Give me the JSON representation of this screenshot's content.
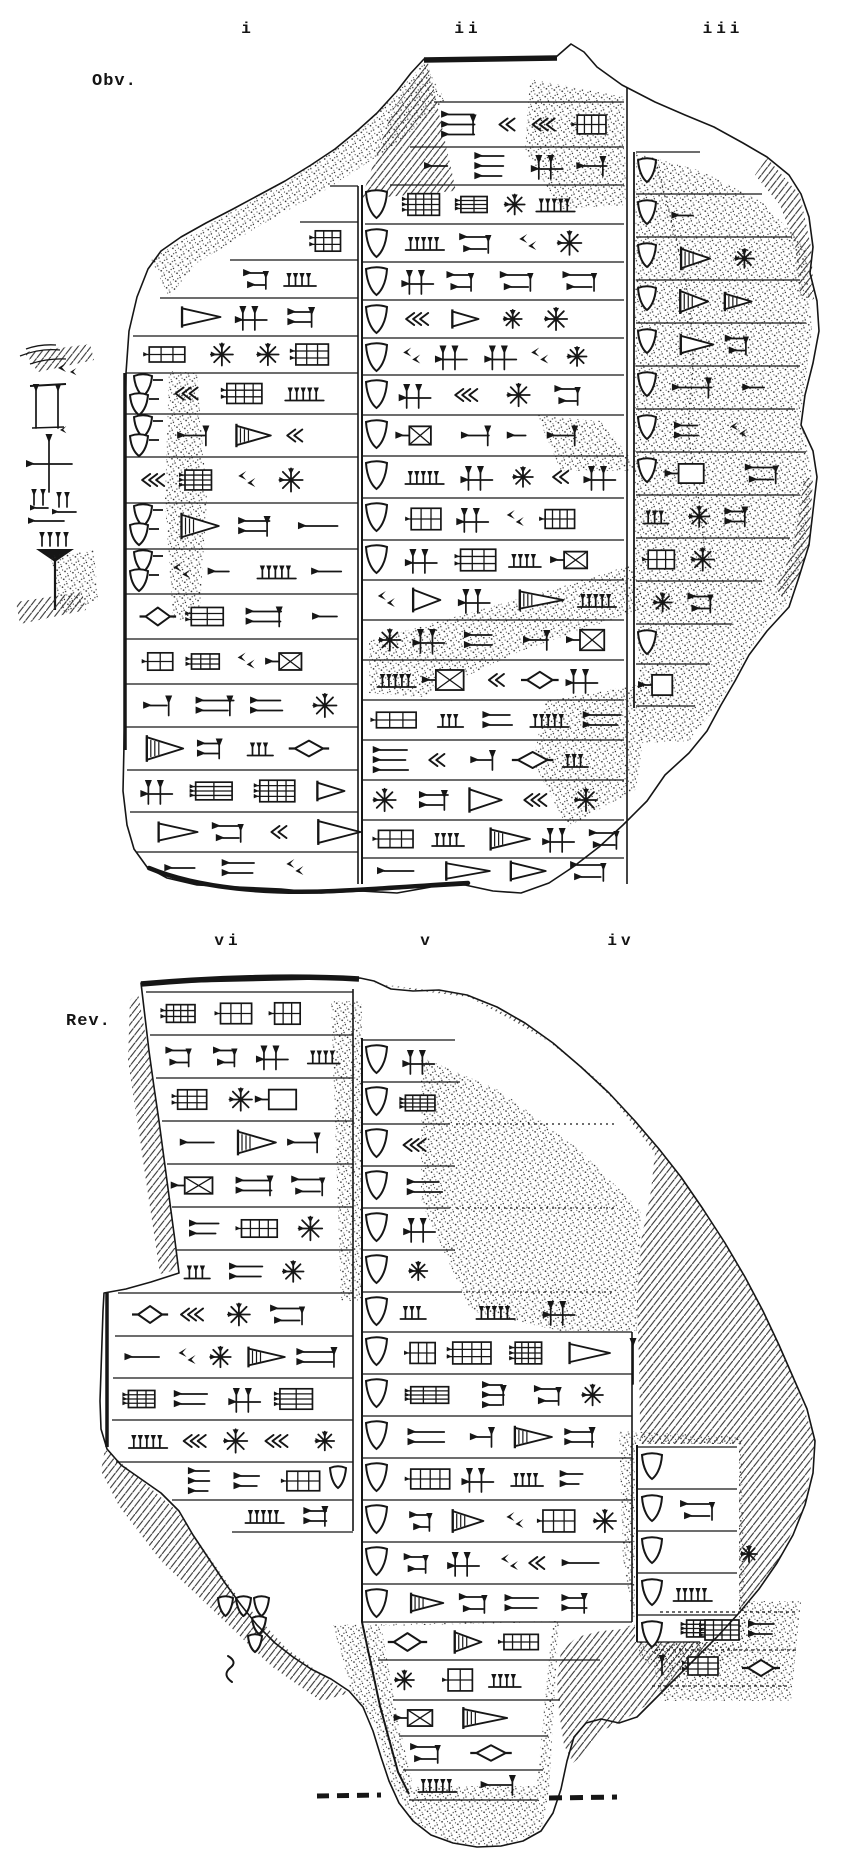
{
  "figure": {
    "kind": "cuneiform tablet hand copy (line drawing), obverse and reverse",
    "obverse": {
      "side_label": "Obv.",
      "column_labels": [
        "i",
        "ii",
        "iii"
      ]
    },
    "reverse": {
      "side_label": "Rev.",
      "column_labels": [
        "vi",
        "v",
        "iv"
      ]
    }
  }
}
